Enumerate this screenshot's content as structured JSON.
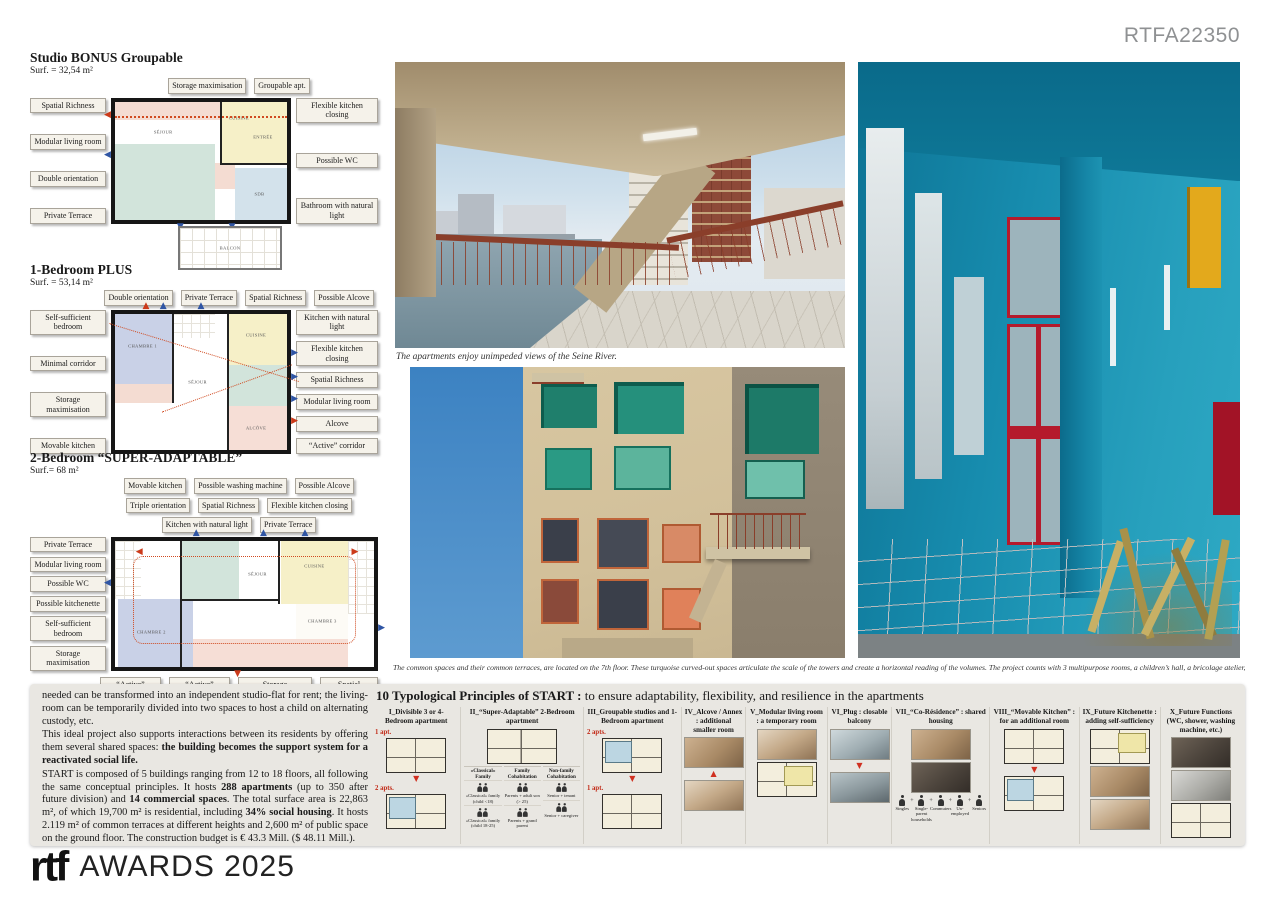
{
  "header": {
    "code": "RTFA22350"
  },
  "colors": {
    "accent_red": "#d04a20",
    "arrow_blue": "#2f55a4",
    "turquoise_photo": "#1487ab",
    "facade_teal": "#2e8b74",
    "band_bg": "#e9e7e2"
  },
  "plans": [
    {
      "title": "Studio BONUS Groupable",
      "surface": "Surf. = 32,54 m²",
      "rooms": [
        "SÉJOUR",
        "CUISINE",
        "ENTRÉE",
        "SDB",
        "BALCON"
      ],
      "labels_top": [
        "Storage maximisation",
        "Groupable apt."
      ],
      "labels_left": [
        "Spatial Richness",
        "Modular living room",
        "Double orientation",
        "Private Terrace"
      ],
      "labels_right": [
        "Flexible kitchen closing",
        "Possible WC",
        "Bathroom with natural light"
      ]
    },
    {
      "title": "1-Bedroom PLUS",
      "surface": "Surf. = 53,14 m²",
      "rooms": [
        "CHAMBRE 1",
        "SÉJOUR",
        "CUISINE",
        "ALCÔVE"
      ],
      "labels_top": [
        "Double orientation",
        "Private Terrace",
        "Spatial Richness",
        "Possible Alcove"
      ],
      "labels_left": [
        "Self-sufficient bedroom",
        "Minimal corridor",
        "Storage maximisation",
        "Movable kitchen"
      ],
      "labels_right": [
        "Kitchen with natural light",
        "Flexible kitchen closing",
        "Spatial Richness",
        "Modular living room",
        "Alcove",
        "“Active” corridor"
      ]
    },
    {
      "title": "2-Bedroom “SUPER-ADAPTABLE”",
      "surface": "Surf.= 68 m²",
      "rooms": [
        "SÉJOUR",
        "CUISINE",
        "CHAMBRE 2",
        "CHAMBRE 3"
      ],
      "labels_top": [
        "Movable kitchen",
        "Possible washing machine",
        "Possible Alcove",
        "Triple orientation",
        "Spatial Richness",
        "Flexible kitchen closing",
        "Kitchen with natural light",
        "Private Terrace"
      ],
      "labels_left": [
        "Private Terrace",
        "Modular living room",
        "Possible WC",
        "Possible kitchenette",
        "Self-sufficient bedroom",
        "Storage maximisation"
      ],
      "labels_bottom": [
        "“Active” corridor",
        "“Active” corridor",
        "Storage maximisation",
        "Spatial Richness"
      ]
    }
  ],
  "photos": [
    {
      "caption": "The apartments enjoy unimpeded views of the Seine River."
    },
    {
      "caption": "The common spaces and their common terraces, are located on the 7th floor. These turquoise curved-out spaces articulate the scale of the towers and create a horizontal reading of the volumes. The project counts with 3 multipurpose rooms, a children’s hall, a bricolage atelier, and two guest rooms."
    }
  ],
  "bottom": {
    "paragraphs": [
      {
        "parts": [
          {
            "t": "needed can be transformed into an independent studio-flat for rent; the living-room can be temporarily divided into two spaces to host a child on alternating custody, etc.",
            "b": false
          }
        ]
      },
      {
        "parts": [
          {
            "t": "This ideal project also supports interactions between its residents by offering them several shared spaces: ",
            "b": false
          },
          {
            "t": "the building becomes the support system for a reactivated social life.",
            "b": true
          }
        ]
      },
      {
        "parts": [
          {
            "t": "START is composed of 5 buildings ranging from 12 to 18 floors, all following the same conceptual principles. It hosts ",
            "b": false
          },
          {
            "t": "288 apartments",
            "b": true
          },
          {
            "t": " (up to 350 after future division) and ",
            "b": false
          },
          {
            "t": "14 commercial spaces",
            "b": true
          },
          {
            "t": ". The total surface area is 22,863 m², of which 19,700 m² is residential, including ",
            "b": false
          },
          {
            "t": "34% social housing",
            "b": true
          },
          {
            "t": ". It hosts 2.119 m² of common terraces at different heights and 2,600 m² of public space on the ground floor.  The construction budget is € 43.3 Mill. ($ 48.11 Mill.).",
            "b": false
          }
        ]
      }
    ],
    "continue_marker": "►►"
  },
  "principles": {
    "title_bold": "10 Typological Principles of START :",
    "title_rest": " to ensure adaptability, flexibility, and resilience in the apartments",
    "items": [
      {
        "title": "I_Divisible 3 or 4-Bedroom apartment",
        "figures": [
          {
            "kind": "badge",
            "text": "1 apt."
          },
          {
            "kind": "plan"
          },
          {
            "kind": "arrow",
            "dir": "down"
          },
          {
            "kind": "badge",
            "text": "2 apts."
          },
          {
            "kind": "plan",
            "variant": "split"
          }
        ]
      },
      {
        "title": "II_“Super-Adaptable” 2-Bedroom apartment",
        "figures": [
          {
            "kind": "plan",
            "variant": "wide"
          },
          {
            "kind": "groups",
            "cols": [
              {
                "header": "«Classical» Family",
                "subs": [
                  "«Classical» family (child <18)",
                  "«Classical» family (child 18-25)"
                ]
              },
              {
                "header": "Family Cohabitation",
                "subs": [
                  "Parents + adult son (> 25)",
                  "Parents + grand parent"
                ]
              },
              {
                "header": "Non-family Cohabitation",
                "subs": [
                  "Senior + tenant",
                  "Senior + caregiver"
                ]
              }
            ]
          }
        ]
      },
      {
        "title": "III_Groupable studios and 1-Bedroom apartment",
        "figures": [
          {
            "kind": "badge",
            "text": "2 apts."
          },
          {
            "kind": "plan",
            "variant": "split"
          },
          {
            "kind": "arrow",
            "dir": "down"
          },
          {
            "kind": "badge",
            "text": "1 apt."
          },
          {
            "kind": "plan"
          }
        ]
      },
      {
        "title": "IV_Alcove / Annex : additional smaller room",
        "figures": [
          {
            "kind": "photo",
            "tone": "warm"
          },
          {
            "kind": "arrow",
            "dir": "up"
          },
          {
            "kind": "photo",
            "tone": "warm2"
          }
        ]
      },
      {
        "title": "V_Modular living room : a temporary room",
        "figures": [
          {
            "kind": "photo",
            "tone": "warm2"
          },
          {
            "kind": "plan",
            "variant": "yellow"
          }
        ]
      },
      {
        "title": "VI_Plug : closable balcony",
        "figures": [
          {
            "kind": "photo",
            "tone": "cool"
          },
          {
            "kind": "arrow",
            "dir": "down"
          },
          {
            "kind": "photo",
            "tone": "cool2"
          }
        ]
      },
      {
        "title": "VII_“Co-Résidence” : shared housing",
        "figures": [
          {
            "kind": "photo",
            "tone": "warm"
          },
          {
            "kind": "photo",
            "tone": "dark"
          },
          {
            "kind": "people",
            "labels": [
              "Singles",
              "Single-parent households",
              "Commuters",
              "Un-employed",
              "Seniors"
            ]
          }
        ]
      },
      {
        "title": "VIII_“Movable Kitchen” : for an additional room",
        "figures": [
          {
            "kind": "plan"
          },
          {
            "kind": "arrow",
            "dir": "down"
          },
          {
            "kind": "plan",
            "variant": "split"
          }
        ]
      },
      {
        "title": "IX_Future Kitchenette : adding self-sufficiency",
        "figures": [
          {
            "kind": "plan",
            "variant": "yellow"
          },
          {
            "kind": "photo",
            "tone": "warm"
          },
          {
            "kind": "photo",
            "tone": "warm2"
          }
        ]
      },
      {
        "title": "X_Future Functions (WC, shower, washing machine, etc.)",
        "figures": [
          {
            "kind": "photo",
            "tone": "dark"
          },
          {
            "kind": "photo",
            "tone": "gray"
          },
          {
            "kind": "plan"
          }
        ]
      }
    ]
  },
  "footer": {
    "logo": "rtf",
    "awards": "AWARDS 2025"
  }
}
